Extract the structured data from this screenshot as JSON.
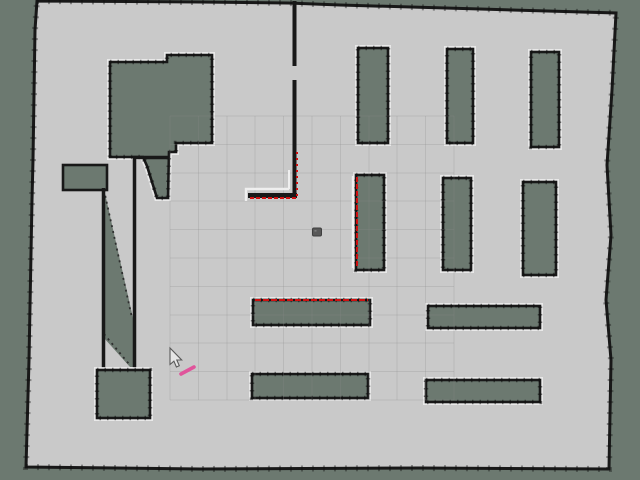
{
  "app": {
    "view_label": "occupancy-grid-map-view"
  },
  "colors": {
    "unknown": "#6c7970",
    "free": "#c9c9c9",
    "wall": "#181818",
    "wall-outline": "#efefef",
    "scan": "#cf1010",
    "grid": "#8b8b8b",
    "robot": "#585858",
    "accent": "#e0549b"
  },
  "scene": {
    "grid": {
      "x": 170,
      "y": 116,
      "spacing": 28.4,
      "cells": 10
    },
    "robot": {
      "x": 317,
      "y": 232
    },
    "cursor": {
      "x": 170,
      "y": 348
    },
    "pose_stroke": {
      "x1": 181,
      "y1": 374,
      "x2": 194,
      "y2": 367
    },
    "scan_segments": [
      {
        "seg": [
          357,
          177,
          357,
          268
        ],
        "dash": "5 2"
      },
      {
        "seg": [
          255,
          300,
          368,
          300
        ],
        "dash": "6 2"
      },
      {
        "seg": [
          250,
          198,
          296,
          198
        ],
        "dash": "4 2"
      },
      {
        "seg": [
          297,
          152,
          297,
          196
        ],
        "dash": "2 4"
      }
    ]
  }
}
